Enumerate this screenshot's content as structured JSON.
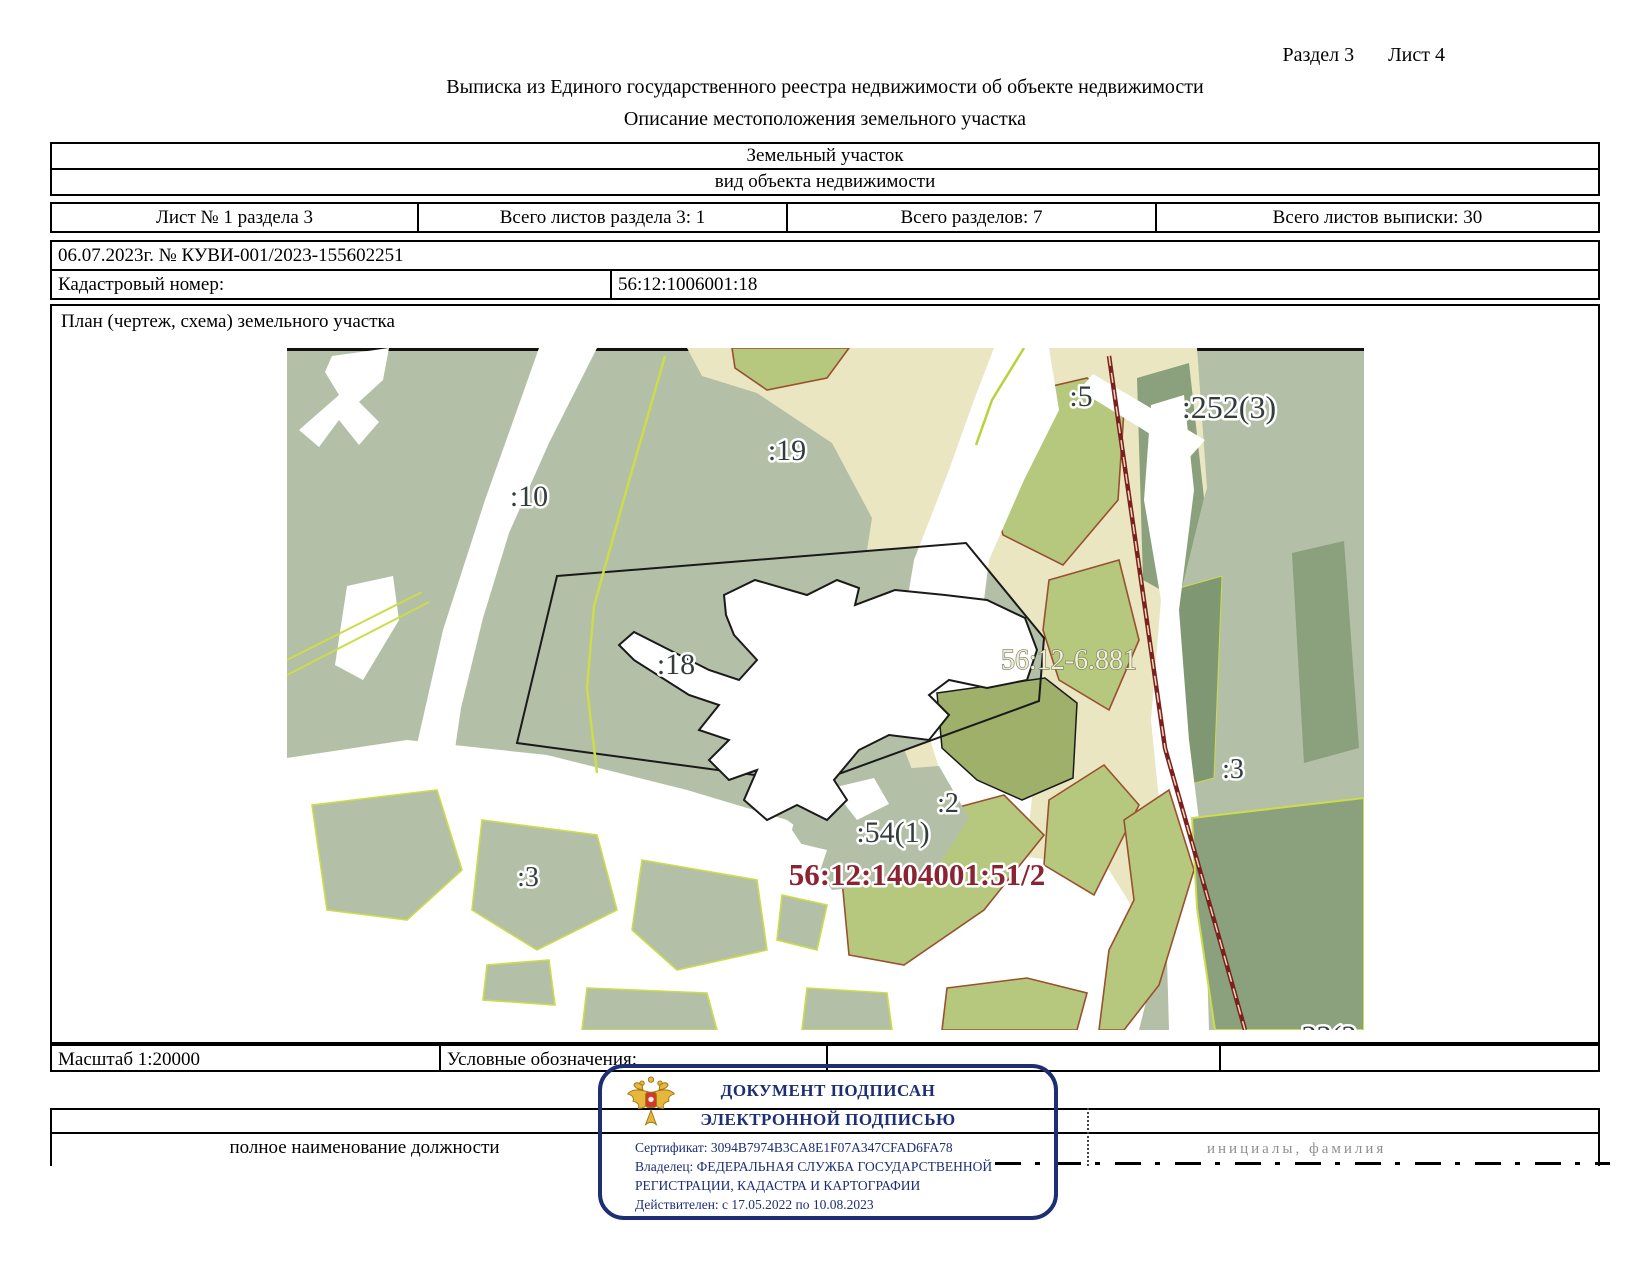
{
  "page": {
    "section_label": "Раздел 3",
    "sheet_label": "Лист 4",
    "title": "Выписка из Единого государственного реестра недвижимости об объекте недвижимости",
    "subtitle": "Описание местоположения земельного участка"
  },
  "object_info": {
    "object_type": "Земельный участок",
    "object_type_caption": "вид объекта недвижимости"
  },
  "sheet_info": {
    "sheet_number": "Лист № 1 раздела 3",
    "section_sheets_total": "Всего листов раздела 3: 1",
    "sections_total": "Всего разделов: 7",
    "statement_sheets_total": "Всего листов выписки: 30"
  },
  "statement": {
    "date_and_number": "06.07.2023г. № КУВИ-001/2023-155602251",
    "cadastral_number_label": "Кадастровый номер:",
    "cadastral_number": "56:12:1006001:18"
  },
  "plan": {
    "caption": "План (чертеж, схема) земельного участка",
    "scale": "Масштаб 1:20000",
    "legend_caption": "Условные обозначения:"
  },
  "map": {
    "labels": [
      {
        "id": "parcel-10",
        "text": ":10"
      },
      {
        "id": "parcel-19",
        "text": ":19"
      },
      {
        "id": "parcel-5",
        "text": ":5"
      },
      {
        "id": "parcel-252-3",
        "text": ":252(3)"
      },
      {
        "id": "parcel-18",
        "text": ":18"
      },
      {
        "id": "zone-56-12-6881",
        "text": "56:12-6.881"
      },
      {
        "id": "parcel-3-right",
        "text": ":3"
      },
      {
        "id": "parcel-2",
        "text": ":2"
      },
      {
        "id": "parcel-54-1",
        "text": ":54(1)"
      },
      {
        "id": "zone-56-12-1404001-51-2",
        "text": "56:12:1404001:51/2"
      },
      {
        "id": "parcel-3-left",
        "text": ":3"
      },
      {
        "id": "parcel-33-2-partial",
        "text": "33(2"
      }
    ],
    "palette": {
      "forest": "#b3bfa6",
      "field": "#b6c87e",
      "field_dark": "#9fb06a",
      "floodplain": "#eae6c1",
      "dark_forest": "#8ba07c",
      "dark_forest2": "#7f9873",
      "water_white": "#ffffff",
      "boundary_field": "#99502e",
      "boundary_bright": "#ccdc4a",
      "boundary_bright2": "#b9d23b",
      "railway": "#7b1f1f",
      "railway_gap": "#ead9b8",
      "parcel_outline": "#1a1a1a",
      "label_dark": "#333d3b",
      "label_light": "#f3eed9",
      "label_red": "#8b2332"
    }
  },
  "stamp": {
    "title_line1": "ДОКУМЕНТ ПОДПИСАН",
    "title_line2": "ЭЛЕКТРОННОЙ ПОДПИСЬЮ",
    "certificate": "Сертификат: 3094B7974B3CA8E1F07A347CFAD6FA78",
    "owner_line1": "Владелец: ФЕДЕРАЛЬНАЯ СЛУЖБА ГОСУДАРСТВЕННОЙ",
    "owner_line2": "РЕГИСТРАЦИИ, КАДАСТРА И КАРТОГРАФИИ",
    "validity": "Действителен: с 17.05.2022 по 10.08.2023",
    "border_color": "#1c2e74"
  },
  "signature": {
    "position_caption": "полное наименование должности",
    "name_caption": "инициалы, фамилия"
  }
}
